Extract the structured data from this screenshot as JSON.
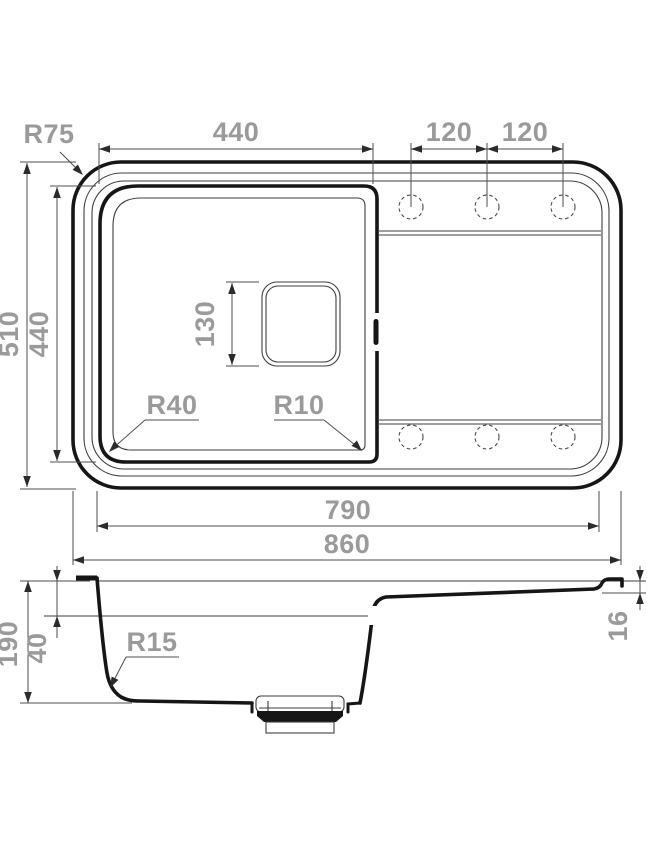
{
  "colors": {
    "outline": "#161616",
    "thin_line": "#3e3e3e",
    "dim_line": "#4d4d4d",
    "dim_text": "#9a9a9a",
    "background": "#ffffff"
  },
  "top_view": {
    "corner_radius": "R75",
    "bowl_width": "440",
    "faucet_spacing_left": "120",
    "faucet_spacing_right": "120",
    "overall_depth": "510",
    "bowl_depth": "440",
    "drain_size": "130",
    "bowl_corner_radius_left": "R40",
    "bowl_corner_radius_right": "R10",
    "inner_width": "790",
    "overall_width": "860"
  },
  "side_view": {
    "overall_height": "190",
    "rim_depth": "40",
    "bottom_corner_radius": "R15",
    "drainboard_depth": "16"
  }
}
